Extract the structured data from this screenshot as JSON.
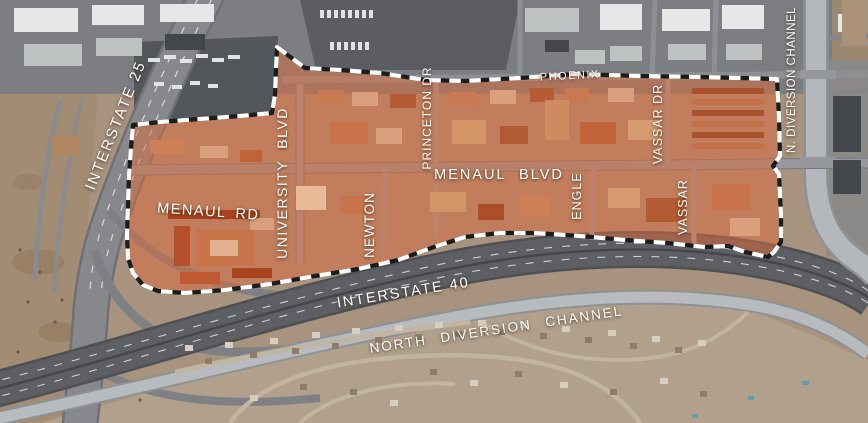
{
  "map": {
    "description": "Aerial photo map of a planning district outlined with a dashed boundary and highlighted in orange",
    "labels": {
      "interstate_25": "INTERSTATE 25",
      "menaul_rd": "MENAUL RD",
      "university_blvd": "UNIVERSITY BLVD",
      "newton": "NEWTON",
      "princeton_dr": "PRINCETON DR",
      "menaul_blvd": "MENAUL BLVD",
      "phoenix": "PHOENIX",
      "vassar_dr": "VASSAR DR",
      "engle": "ENGLE",
      "vassar": "VASSAR",
      "n_diversion_channel": "N. DIVERSION CHANNEL",
      "interstate_40": "INTERSTATE 40",
      "north_diversion_channel": "NORTH DIVERSION CHANNEL"
    },
    "colors": {
      "district_fill": "#dd6a3a",
      "boundary_dash_light": "#ffffff",
      "boundary_dash_dark": "#1c1c1c",
      "label_text": "#ffffff"
    }
  }
}
